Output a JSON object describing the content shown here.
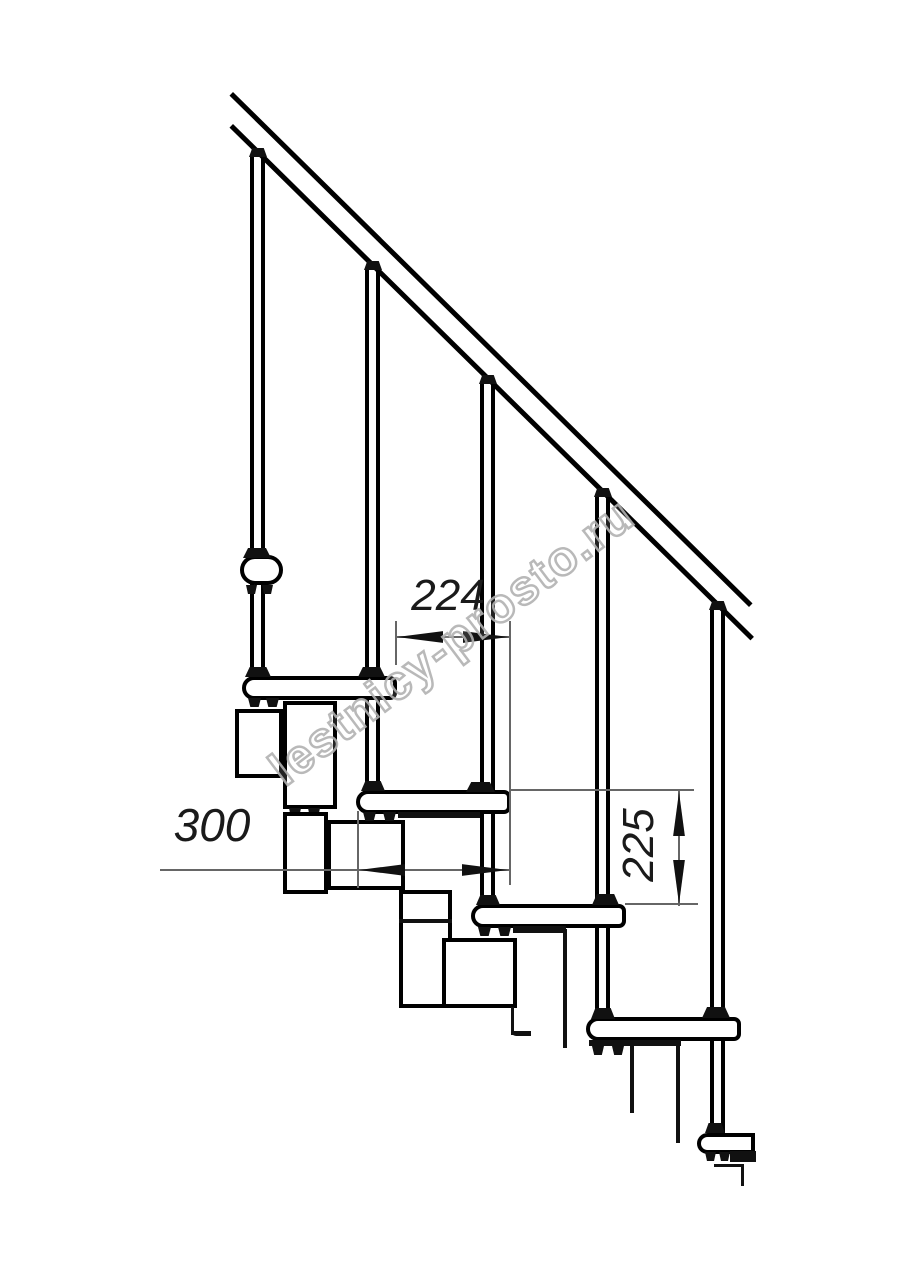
{
  "drawing": {
    "dimensions": {
      "step_run": "224",
      "tread_length": "300",
      "step_rise": "225"
    },
    "watermark": {
      "text": "lestnicy-prosto.ru",
      "color": "#b2b2b2"
    },
    "colors": {
      "line": "#000000",
      "dimension_line": "#666666",
      "background": "#ffffff"
    }
  }
}
